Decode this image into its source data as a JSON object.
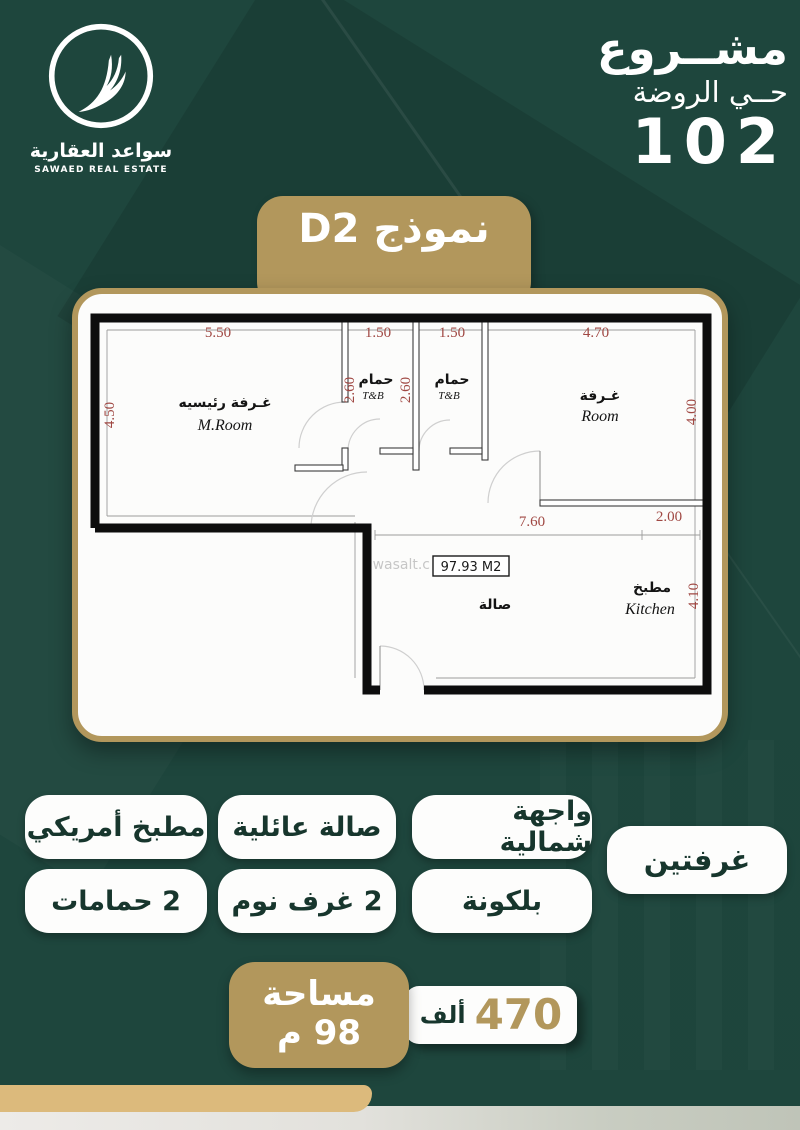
{
  "brand": {
    "name_ar": "سواعد العقارية",
    "name_en": "SAWAED REAL ESTATE"
  },
  "project": {
    "word": "مشــروع",
    "district": "حــي الروضة",
    "number": "102"
  },
  "model_banner": "نموذج D2",
  "plan": {
    "rooms": {
      "master_ar": "غـرفة رئيسيه",
      "master_en": "M.Room",
      "bath1_ar": "حمام",
      "bath1_en": "T&B",
      "bath2_ar": "حمام",
      "bath2_en": "T&B",
      "room_ar": "غـرفة",
      "room_en": "Room",
      "hall_ar": "صالة",
      "kitchen_ar": "مطبخ",
      "kitchen_en": "Kitchen"
    },
    "dims": {
      "master_w": "5.50",
      "bath1_w": "1.50",
      "bath2_w": "1.50",
      "room_w": "4.70",
      "master_h": "4.50",
      "bath1_h": "2.60",
      "bath2_h": "2.60",
      "room_h": "4.00",
      "hall_w": "7.60",
      "kitchen_w": "2.00",
      "kitchen_h": "4.10"
    },
    "area_box": "97.93 M2",
    "watermark": "wasalt.c"
  },
  "features": [
    "مطبخ أمريكي",
    "صالة عائلية",
    "واجهة شمالية",
    "غرفتين",
    "2 حمامات",
    "2 غرف نوم",
    "بلكونة"
  ],
  "offer": {
    "area_label": "مساحة",
    "area_value": "98 م",
    "price_number": "470",
    "price_unit": "ألف"
  },
  "colors": {
    "background_green": "#1e463d",
    "tan_gold": "#b2975c",
    "badge_text_green": "#17362d",
    "dimension_red": "#a04843",
    "strip_tan": "#dcba7c"
  }
}
